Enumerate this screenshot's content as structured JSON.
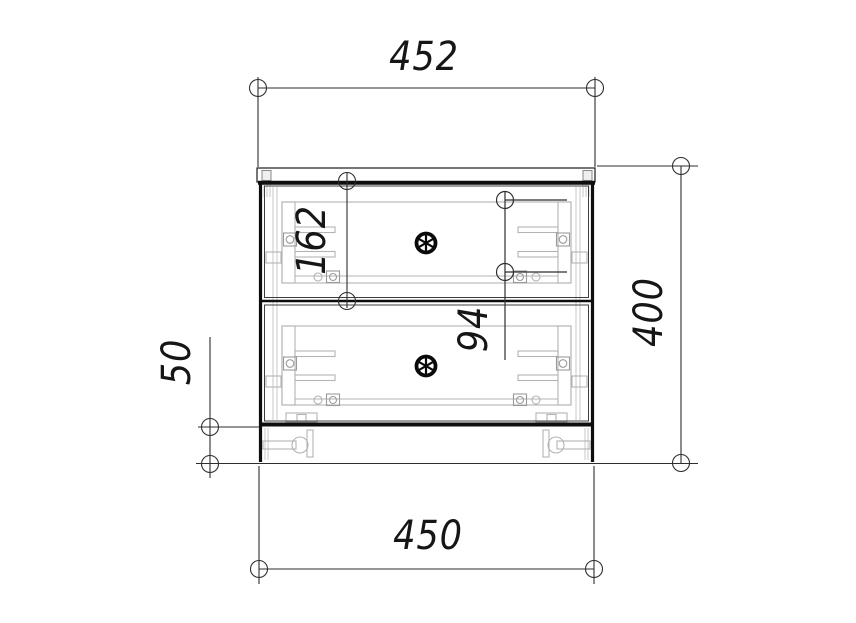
{
  "drawing": {
    "view": "cabinet-front-elevation",
    "background_color": "#ffffff",
    "outline_color": "#141414",
    "dimension_line_color": "#2e2e2e",
    "fitting_color": "#b3b3b3",
    "icons": {
      "knob": "wheel-with-six-spokes",
      "dimension_terminator": "open-circle"
    }
  },
  "dimensions": {
    "top_width": {
      "value": "452",
      "orientation": "horizontal"
    },
    "bottom_width": {
      "value": "450",
      "orientation": "horizontal"
    },
    "overall_height": {
      "value": "400",
      "orientation": "vertical"
    },
    "drawer_front_height": {
      "value": "162",
      "orientation": "vertical"
    },
    "handle_offset": {
      "value": "94",
      "orientation": "vertical"
    },
    "plinth_height": {
      "value": "50",
      "orientation": "vertical"
    }
  }
}
